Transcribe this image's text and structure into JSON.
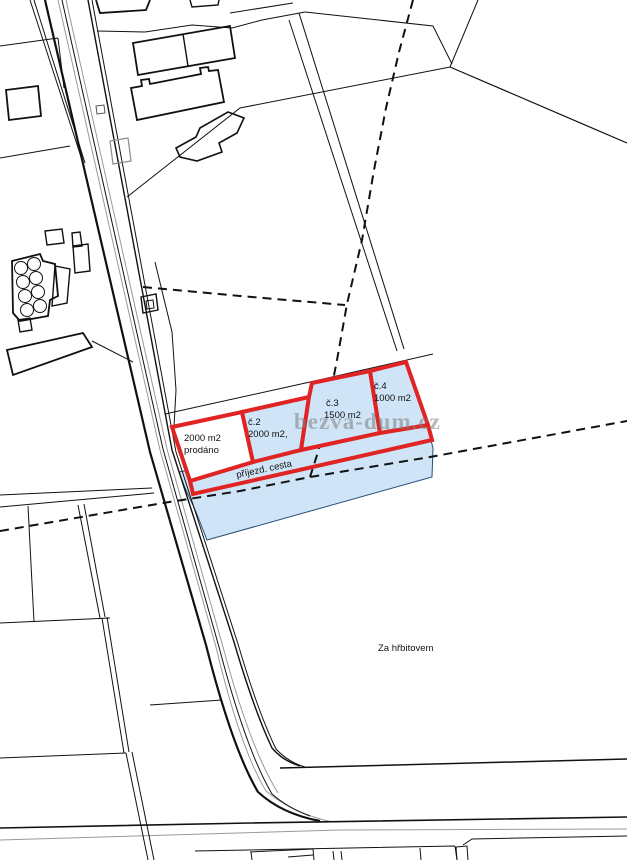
{
  "map": {
    "type": "cadastral-plan",
    "watermark": "bezva-dum.cz",
    "area_label": "Za hřbitovem",
    "access_road_label": "příjezd. cesta",
    "parcels": [
      {
        "name": "parcel-1",
        "line1": "2000 m2",
        "line2": "prodáno",
        "status": "sold"
      },
      {
        "name": "parcel-2",
        "line1": "č.2",
        "line2": "2000 m2,"
      },
      {
        "name": "parcel-3",
        "line1": "č.3",
        "line2": "1500 m2"
      },
      {
        "name": "parcel-4",
        "line1": "č.4",
        "line2": "1000 m2"
      }
    ],
    "colors": {
      "parcel_outline": "#e02424",
      "highlight_fill": "#cfe4f6",
      "highlight_edge": "#2a4f78",
      "map_line": "#111111",
      "secondary_line": "#999999",
      "watermark": "#808080"
    }
  }
}
